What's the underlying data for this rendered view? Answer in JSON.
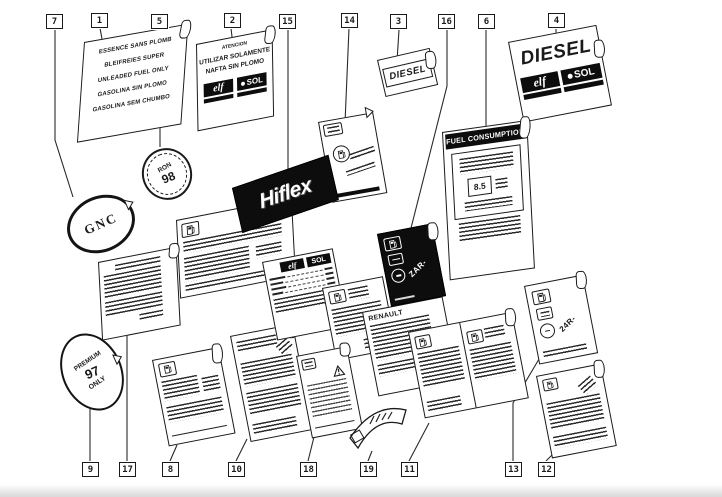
{
  "figure": {
    "description": "Exploded diagram of vehicle fuel information labels with numbered callouts",
    "colors": {
      "paper": "#ffffff",
      "ink": "#1a1a1a",
      "badge_black": "#0d0d0d"
    }
  },
  "callouts": {
    "top": [
      "7",
      "1",
      "5",
      "2",
      "15",
      "14",
      "3",
      "16",
      "6",
      "4"
    ],
    "bottom": [
      "9",
      "17",
      "8",
      "10",
      "18",
      "19",
      "11",
      "13",
      "12"
    ]
  },
  "label_unleaded": {
    "l1": "ESSENCE SANS PLOMB",
    "l2": "BLEIFREIES SUPER",
    "l3": "UNLEADED FUEL ONLY",
    "l4": "GASOLINA SIN PLOMO",
    "l5": "GASOLINA SEM CHUMBO"
  },
  "label_nafta": {
    "heading": "ATENCION",
    "l1": "UTILIZAR SOLAMENTE",
    "l2": "NAFTA SIN PLOMO"
  },
  "brands": {
    "elf": "elf",
    "sol": "SOL"
  },
  "label_diesel_small": {
    "text": "DIESEL"
  },
  "label_diesel_large": {
    "text": "DIESEL"
  },
  "badge_ron98": {
    "top": "RON",
    "num": "98"
  },
  "label_fuel_consumption": {
    "header": "FUEL CONSUMPTION",
    "value": "8.5"
  },
  "badge_gnc": {
    "text": "GNC"
  },
  "badge_hiflex": {
    "text": "Hiflex"
  },
  "label_zar": {
    "code": "ZAR-"
  },
  "label_24r": {
    "code": "24R-"
  },
  "badge_premium": {
    "t": "PREMIUM",
    "n": "97",
    "b": "ONLY"
  },
  "panel_renault": {
    "heading": "RENAULT"
  }
}
